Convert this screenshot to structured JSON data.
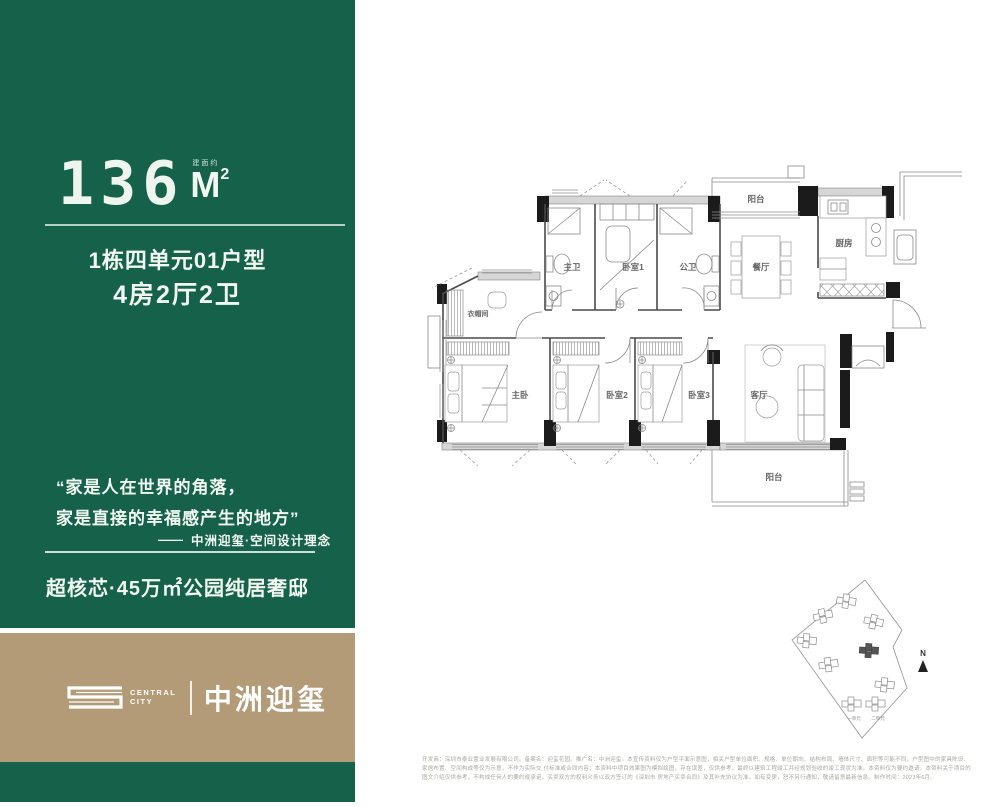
{
  "panel": {
    "area": {
      "note": "建面约",
      "number": "136",
      "unit": "M",
      "sup": "2"
    },
    "unit_line": "1栋四单元01户型",
    "layout_line": "4房2厅2卫",
    "quote_line1": "“家是人在世界的角落，",
    "quote_line2": "家是直接的幸福感产生的地方”",
    "attr_dash": "——",
    "attribution": "中洲迎玺·空间设计理念",
    "slogan": "超核芯·45万㎡公园纯居奢邸",
    "colors": {
      "green": "#15614A",
      "tan": "#B39B78"
    }
  },
  "brand": {
    "logo_glyph": "S",
    "name_en_top": "CENTRAL",
    "name_en_bottom": "CITY",
    "name_cn": "中洲迎玺"
  },
  "floorplan": {
    "rooms": {
      "master_bath": "主卫",
      "bedroom1": "卧室1",
      "public_bath": "公卫",
      "balcony_top": "阳台",
      "dining": "餐厅",
      "kitchen": "厨房",
      "closet": "衣帽间",
      "master_bedroom": "主卧",
      "bedroom2": "卧室2",
      "bedroom3": "卧室3",
      "living": "客厅",
      "balcony_bottom": "阳台"
    }
  },
  "siteplan": {
    "compass": "N",
    "unit1": "一单元",
    "unit2": "二单元"
  },
  "disclaimer": {
    "line1": "开发商：深圳市泰业置业发展有限公司。备案名：迎玺花园。推广名：中洲迎玺。本宣传资料仅为户型平面示意图，相关户型单位面积、规格、单位朝向、结构布局、墙体尺寸、面积等可能不同，户型图中的家具陈设、家居布置、空间构成等仅为示意，不作为实际交",
    "line2": "付标准或合同内容；本资料中项目效果图为模拟绘图，存在误差，仅供参考，最终以建筑工程竣工并经规划验收的竣工现状为准。本资料仅为要约邀请，本资料关于项目的图文介绍仅供参考，不构成任何人的要约或承诺。买卖双方的权利义务以双方签订的《深圳市",
    "line3": "房地产买卖合同》及其补充协议为准。如有变更，恕不另行通知，敬请留意最新信息。制作时间：2023年6月。"
  }
}
